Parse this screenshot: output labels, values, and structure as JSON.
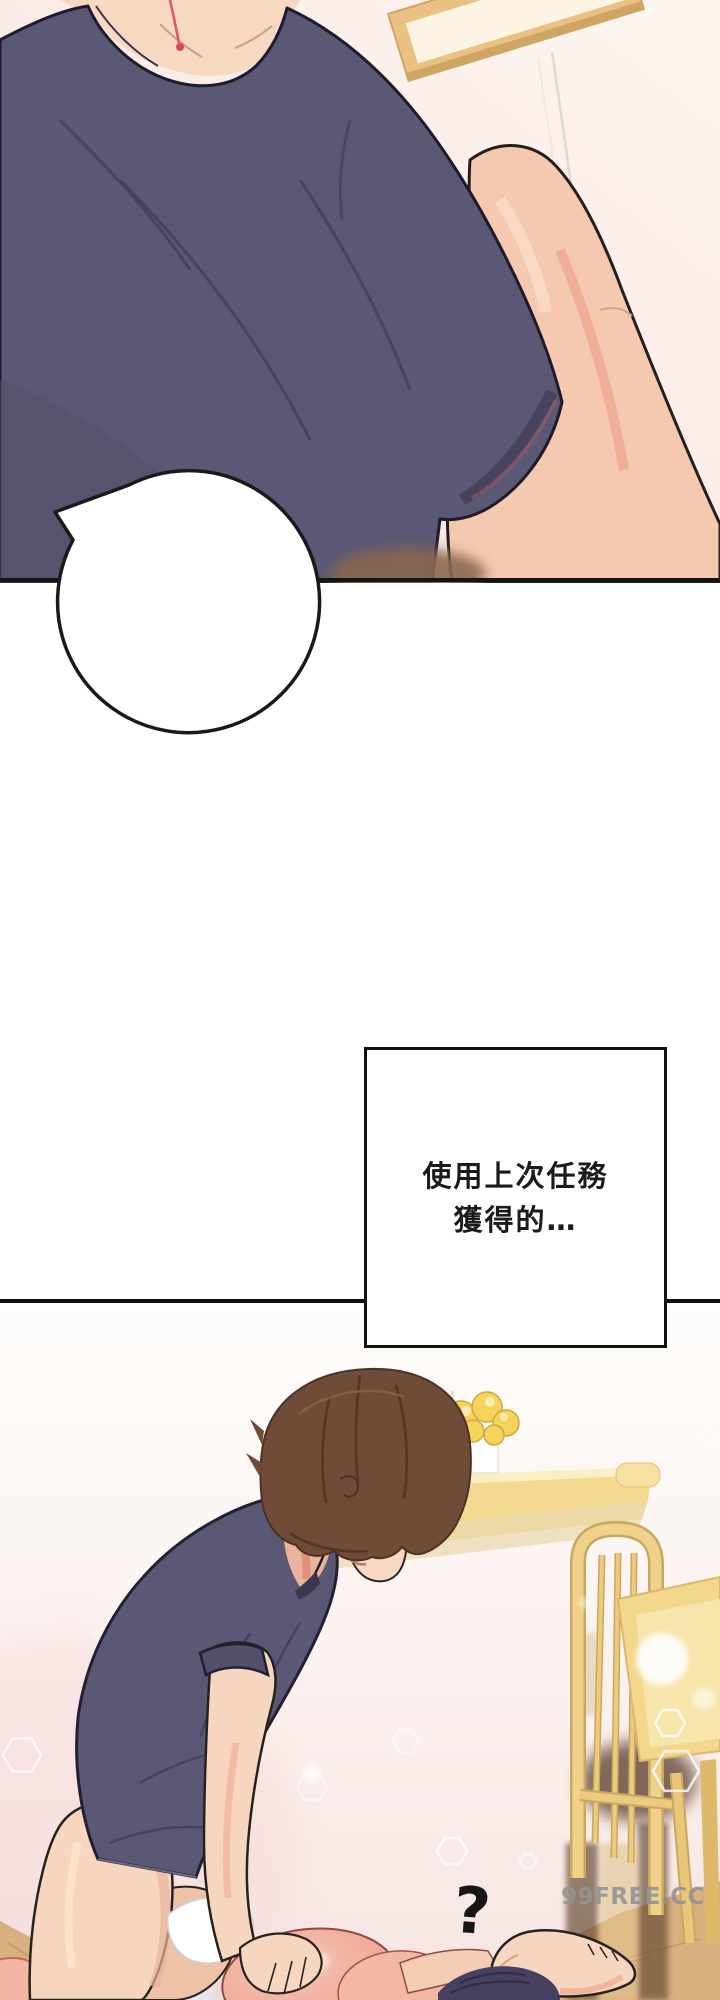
{
  "page": {
    "kind": "webtoon comic page",
    "width": 720,
    "height": 2000
  },
  "texts": {
    "speech_bubble": "什麼獎勵…?",
    "caption_line1": "使用上次任務",
    "caption_line2": "獲得的…",
    "question_mark": "?",
    "watermark": "99FREE.CC"
  },
  "colors": {
    "shirt_navy": "#5a5874",
    "skin_tone": "#f6d6be",
    "arm_blush": "#f2bda6",
    "wall_pink": "#f7e3e1",
    "wood_furniture": "#f3d88e",
    "floor_tan": "#d8b080",
    "hair_brown": "#6f4b38",
    "lying_hair_dark": "#474060",
    "outline_black": "#1c1826",
    "watermark_gray": "#949494"
  }
}
